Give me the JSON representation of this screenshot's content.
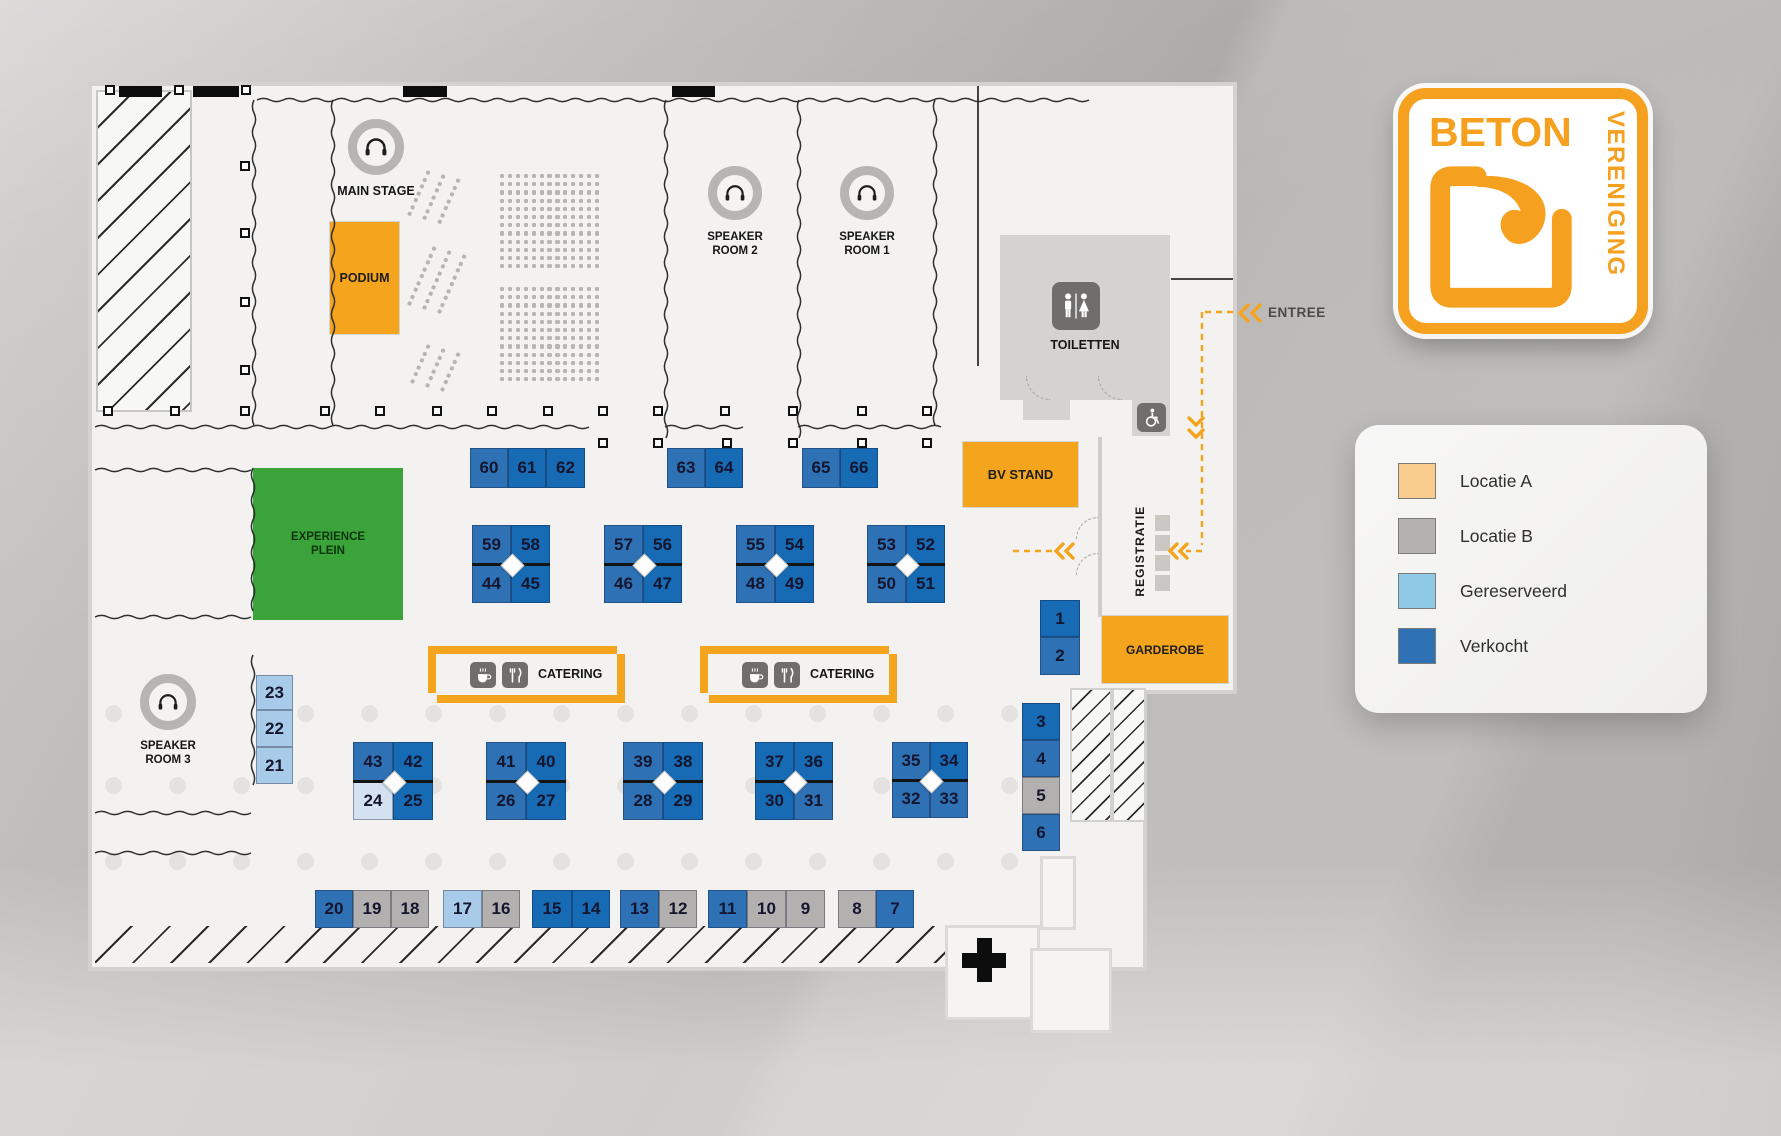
{
  "labels": {
    "main_stage": "MAIN STAGE",
    "podium": "PODIUM",
    "speaker_room_1": "SPEAKER\nROOM 1",
    "speaker_room_2": "SPEAKER\nROOM 2",
    "speaker_room_3": "SPEAKER\nROOM 3",
    "toiletten": "TOILETTEN",
    "bv_stand": "BV STAND",
    "experience_plein": "EXPERIENCE\nPLEIN",
    "catering": "CATERING",
    "registratie": "REGISTRATIE",
    "garderobe": "GARDEROBE",
    "entree": "ENTREE"
  },
  "logo": {
    "word1": "BETON",
    "word2": "VERENIGING"
  },
  "legend": {
    "items": [
      {
        "label": "Locatie A",
        "color": "#f8cd8e"
      },
      {
        "label": "Locatie B",
        "color": "#b3b2b1"
      },
      {
        "label": "Gereserveerd",
        "color": "#8ecae6"
      },
      {
        "label": "Verkocht",
        "color": "#2e72b5"
      }
    ]
  },
  "colors": {
    "accent": "#f4a41d",
    "green": "#3aa33a",
    "floor": "#f3f2f1",
    "status": {
      "v": "#2e72b5",
      "vd": "#176ab4",
      "g": "#a7cbe8",
      "gl": "#d3e1f0",
      "b": "#b2b1b0"
    }
  },
  "booths": [
    {
      "n": "60",
      "x": 470,
      "y": 448,
      "w": 38,
      "h": 40,
      "s": "v"
    },
    {
      "n": "61",
      "x": 508,
      "y": 448,
      "w": 38,
      "h": 40,
      "s": "vd"
    },
    {
      "n": "62",
      "x": 546,
      "y": 448,
      "w": 39,
      "h": 40,
      "s": "vd"
    },
    {
      "n": "63",
      "x": 667,
      "y": 448,
      "w": 38,
      "h": 40,
      "s": "v"
    },
    {
      "n": "64",
      "x": 705,
      "y": 448,
      "w": 38,
      "h": 40,
      "s": "vd"
    },
    {
      "n": "65",
      "x": 802,
      "y": 448,
      "w": 38,
      "h": 40,
      "s": "v"
    },
    {
      "n": "66",
      "x": 840,
      "y": 448,
      "w": 38,
      "h": 40,
      "s": "vd"
    },
    {
      "n": "59",
      "x": 472,
      "y": 525,
      "w": 39,
      "h": 39,
      "s": "v"
    },
    {
      "n": "58",
      "x": 511,
      "y": 525,
      "w": 39,
      "h": 39,
      "s": "vd"
    },
    {
      "n": "44",
      "x": 472,
      "y": 564,
      "w": 39,
      "h": 39,
      "s": "v"
    },
    {
      "n": "45",
      "x": 511,
      "y": 564,
      "w": 39,
      "h": 39,
      "s": "vd"
    },
    {
      "n": "57",
      "x": 604,
      "y": 525,
      "w": 39,
      "h": 39,
      "s": "v"
    },
    {
      "n": "56",
      "x": 643,
      "y": 525,
      "w": 39,
      "h": 39,
      "s": "vd"
    },
    {
      "n": "46",
      "x": 604,
      "y": 564,
      "w": 39,
      "h": 39,
      "s": "v"
    },
    {
      "n": "47",
      "x": 643,
      "y": 564,
      "w": 39,
      "h": 39,
      "s": "vd"
    },
    {
      "n": "55",
      "x": 736,
      "y": 525,
      "w": 39,
      "h": 39,
      "s": "v"
    },
    {
      "n": "54",
      "x": 775,
      "y": 525,
      "w": 39,
      "h": 39,
      "s": "vd"
    },
    {
      "n": "48",
      "x": 736,
      "y": 564,
      "w": 39,
      "h": 39,
      "s": "v"
    },
    {
      "n": "49",
      "x": 775,
      "y": 564,
      "w": 39,
      "h": 39,
      "s": "vd"
    },
    {
      "n": "53",
      "x": 867,
      "y": 525,
      "w": 39,
      "h": 39,
      "s": "v"
    },
    {
      "n": "52",
      "x": 906,
      "y": 525,
      "w": 39,
      "h": 39,
      "s": "vd"
    },
    {
      "n": "50",
      "x": 867,
      "y": 564,
      "w": 39,
      "h": 39,
      "s": "v"
    },
    {
      "n": "51",
      "x": 906,
      "y": 564,
      "w": 39,
      "h": 39,
      "s": "vd"
    },
    {
      "n": "43",
      "x": 353,
      "y": 742,
      "w": 40,
      "h": 39,
      "s": "v"
    },
    {
      "n": "42",
      "x": 393,
      "y": 742,
      "w": 40,
      "h": 39,
      "s": "vd"
    },
    {
      "n": "24",
      "x": 353,
      "y": 781,
      "w": 40,
      "h": 39,
      "s": "gl"
    },
    {
      "n": "25",
      "x": 393,
      "y": 781,
      "w": 40,
      "h": 39,
      "s": "vd"
    },
    {
      "n": "41",
      "x": 486,
      "y": 742,
      "w": 40,
      "h": 39,
      "s": "v"
    },
    {
      "n": "40",
      "x": 526,
      "y": 742,
      "w": 40,
      "h": 39,
      "s": "vd"
    },
    {
      "n": "26",
      "x": 486,
      "y": 781,
      "w": 40,
      "h": 39,
      "s": "v"
    },
    {
      "n": "27",
      "x": 526,
      "y": 781,
      "w": 40,
      "h": 39,
      "s": "vd"
    },
    {
      "n": "39",
      "x": 623,
      "y": 742,
      "w": 40,
      "h": 39,
      "s": "v"
    },
    {
      "n": "38",
      "x": 663,
      "y": 742,
      "w": 40,
      "h": 39,
      "s": "vd"
    },
    {
      "n": "28",
      "x": 623,
      "y": 781,
      "w": 40,
      "h": 39,
      "s": "v"
    },
    {
      "n": "29",
      "x": 663,
      "y": 781,
      "w": 40,
      "h": 39,
      "s": "vd"
    },
    {
      "n": "37",
      "x": 755,
      "y": 742,
      "w": 39,
      "h": 39,
      "s": "vd"
    },
    {
      "n": "36",
      "x": 794,
      "y": 742,
      "w": 39,
      "h": 39,
      "s": "vd"
    },
    {
      "n": "30",
      "x": 755,
      "y": 781,
      "w": 39,
      "h": 39,
      "s": "vd"
    },
    {
      "n": "31",
      "x": 794,
      "y": 781,
      "w": 39,
      "h": 39,
      "s": "v"
    },
    {
      "n": "35",
      "x": 892,
      "y": 742,
      "w": 38,
      "h": 38,
      "s": "v"
    },
    {
      "n": "34",
      "x": 930,
      "y": 742,
      "w": 38,
      "h": 38,
      "s": "vd"
    },
    {
      "n": "32",
      "x": 892,
      "y": 780,
      "w": 38,
      "h": 38,
      "s": "v"
    },
    {
      "n": "33",
      "x": 930,
      "y": 780,
      "w": 38,
      "h": 38,
      "s": "v"
    },
    {
      "n": "1",
      "x": 1040,
      "y": 600,
      "w": 40,
      "h": 37,
      "s": "vd"
    },
    {
      "n": "2",
      "x": 1040,
      "y": 637,
      "w": 40,
      "h": 38,
      "s": "v"
    },
    {
      "n": "3",
      "x": 1022,
      "y": 703,
      "w": 38,
      "h": 37,
      "s": "vd"
    },
    {
      "n": "4",
      "x": 1022,
      "y": 740,
      "w": 38,
      "h": 37,
      "s": "v"
    },
    {
      "n": "5",
      "x": 1022,
      "y": 777,
      "w": 38,
      "h": 37,
      "s": "b"
    },
    {
      "n": "6",
      "x": 1022,
      "y": 814,
      "w": 38,
      "h": 37,
      "s": "v"
    },
    {
      "n": "23",
      "x": 256,
      "y": 675,
      "w": 37,
      "h": 35,
      "s": "g"
    },
    {
      "n": "22",
      "x": 256,
      "y": 710,
      "w": 37,
      "h": 37,
      "s": "g"
    },
    {
      "n": "21",
      "x": 256,
      "y": 747,
      "w": 37,
      "h": 37,
      "s": "g"
    },
    {
      "n": "20",
      "x": 315,
      "y": 890,
      "w": 38,
      "h": 38,
      "s": "v"
    },
    {
      "n": "19",
      "x": 353,
      "y": 890,
      "w": 38,
      "h": 38,
      "s": "b"
    },
    {
      "n": "18",
      "x": 391,
      "y": 890,
      "w": 38,
      "h": 38,
      "s": "b"
    },
    {
      "n": "17",
      "x": 443,
      "y": 890,
      "w": 39,
      "h": 38,
      "s": "g"
    },
    {
      "n": "16",
      "x": 482,
      "y": 890,
      "w": 38,
      "h": 38,
      "s": "b"
    },
    {
      "n": "15",
      "x": 532,
      "y": 890,
      "w": 40,
      "h": 38,
      "s": "vd"
    },
    {
      "n": "14",
      "x": 572,
      "y": 890,
      "w": 38,
      "h": 38,
      "s": "vd"
    },
    {
      "n": "13",
      "x": 620,
      "y": 890,
      "w": 39,
      "h": 38,
      "s": "v"
    },
    {
      "n": "12",
      "x": 659,
      "y": 890,
      "w": 38,
      "h": 38,
      "s": "b"
    },
    {
      "n": "11",
      "x": 708,
      "y": 890,
      "w": 39,
      "h": 38,
      "s": "v"
    },
    {
      "n": "10",
      "x": 747,
      "y": 890,
      "w": 39,
      "h": 38,
      "s": "b"
    },
    {
      "n": "9",
      "x": 786,
      "y": 890,
      "w": 39,
      "h": 38,
      "s": "b"
    },
    {
      "n": "8",
      "x": 838,
      "y": 890,
      "w": 38,
      "h": 38,
      "s": "b"
    },
    {
      "n": "7",
      "x": 876,
      "y": 890,
      "w": 38,
      "h": 38,
      "s": "v"
    }
  ],
  "clusters": [
    {
      "x": 472,
      "y": 525,
      "w": 78,
      "h": 78
    },
    {
      "x": 604,
      "y": 525,
      "w": 78,
      "h": 78
    },
    {
      "x": 736,
      "y": 525,
      "w": 78,
      "h": 78
    },
    {
      "x": 867,
      "y": 525,
      "w": 78,
      "h": 78
    },
    {
      "x": 353,
      "y": 742,
      "w": 80,
      "h": 78
    },
    {
      "x": 486,
      "y": 742,
      "w": 80,
      "h": 78
    },
    {
      "x": 623,
      "y": 742,
      "w": 80,
      "h": 78
    },
    {
      "x": 755,
      "y": 742,
      "w": 78,
      "h": 78
    },
    {
      "x": 892,
      "y": 742,
      "w": 76,
      "h": 76
    }
  ],
  "decor": {
    "black_bars": [
      [
        119,
        43
      ],
      [
        193,
        46
      ],
      [
        403,
        44
      ],
      [
        672,
        43
      ]
    ],
    "pillars": [
      [
        110,
        90
      ],
      [
        179,
        90
      ],
      [
        246,
        90
      ],
      [
        245,
        166
      ],
      [
        245,
        233
      ],
      [
        245,
        302
      ],
      [
        245,
        370
      ],
      [
        108,
        411
      ],
      [
        175,
        411
      ],
      [
        245,
        411
      ],
      [
        325,
        411
      ],
      [
        380,
        411
      ],
      [
        437,
        411
      ],
      [
        492,
        411
      ],
      [
        548,
        411
      ],
      [
        603,
        411
      ],
      [
        658,
        411
      ],
      [
        725,
        411
      ],
      [
        793,
        411
      ],
      [
        862,
        411
      ],
      [
        927,
        411
      ],
      [
        603,
        443
      ],
      [
        658,
        443
      ],
      [
        727,
        443
      ],
      [
        793,
        443
      ],
      [
        862,
        443
      ],
      [
        927,
        443
      ]
    ],
    "dot_rows": [
      {
        "y": 705,
        "xs": [
          105,
          297,
          361,
          425,
          489,
          553,
          617,
          681,
          745,
          809,
          873,
          937,
          1001
        ]
      },
      {
        "y": 777,
        "xs": [
          105,
          169,
          233,
          297,
          361,
          425,
          489,
          553,
          617,
          681,
          745,
          809,
          873,
          937,
          1001
        ]
      },
      {
        "y": 853,
        "xs": [
          105,
          169,
          233,
          297,
          361,
          425,
          489,
          553,
          617,
          681,
          745,
          809,
          873,
          937,
          1001
        ]
      }
    ],
    "seat_grids": [
      {
        "x": 500,
        "y": 174,
        "cols": 13,
        "rows": 12
      },
      {
        "x": 500,
        "y": 287,
        "cols": 13,
        "rows": 12
      }
    ],
    "seat_angled": [
      {
        "x": 427,
        "y": 170,
        "rows": 7
      },
      {
        "x": 433,
        "y": 246,
        "rows": 9
      },
      {
        "x": 427,
        "y": 344,
        "rows": 6
      }
    ]
  }
}
